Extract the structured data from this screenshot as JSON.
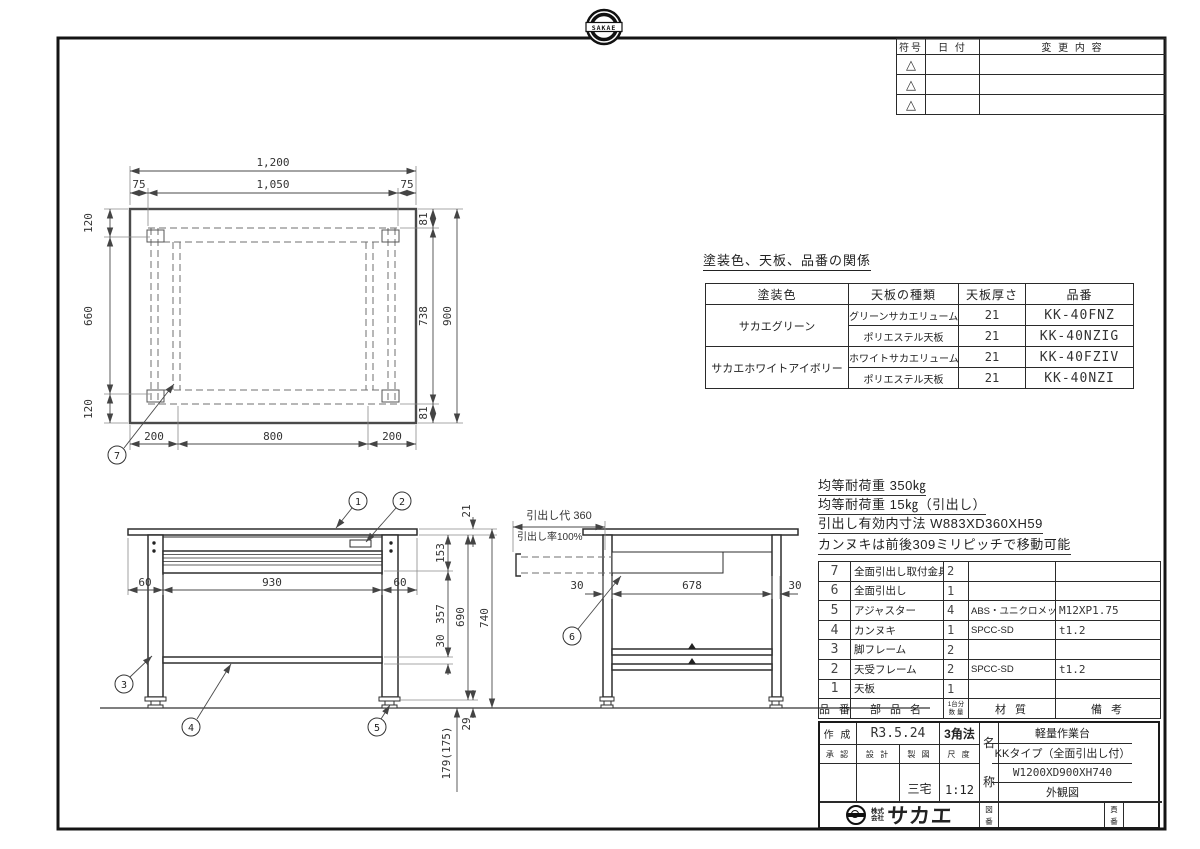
{
  "stamp": {
    "text": "SAKAE"
  },
  "rev": {
    "h_symbol": "符号",
    "h_date": "日 付",
    "h_change": "変 更 内 容",
    "triangle": "△"
  },
  "finish": {
    "title": "塗装色、天板、品番の関係",
    "h_color": "塗装色",
    "h_type": "天板の種類",
    "h_thick": "天板厚さ",
    "h_part": "品番",
    "color1": "サカエグリーン",
    "color2": "サカエホワイトアイボリー",
    "rows": [
      {
        "type": "グリーンサカエリューム天板",
        "thick": "21",
        "part": "KK-40FNZ"
      },
      {
        "type": "ポリエステル天板",
        "thick": "21",
        "part": "KK-40NZIG"
      },
      {
        "type": "ホワイトサカエリューム天板",
        "thick": "21",
        "part": "KK-40FZIV"
      },
      {
        "type": "ポリエステル天板",
        "thick": "21",
        "part": "KK-40NZI"
      }
    ]
  },
  "notes": {
    "line1": "均等耐荷重 350㎏",
    "line2": "均等耐荷重 15㎏（引出し）",
    "line3": "引出し有効内寸法 W883XD360XH59",
    "line4": "カンヌキは前後309ミリピッチで移動可能"
  },
  "parts": {
    "h_no": "品 番",
    "h_name": "部 品 名",
    "h_qty1": "1台分",
    "h_qty2": "数 量",
    "h_mat": "材 質",
    "h_rem": "備 考",
    "rows": [
      {
        "no": "7",
        "name": "全面引出し取付金具",
        "qty": "2",
        "mat": "",
        "rem": ""
      },
      {
        "no": "6",
        "name": "全面引出し",
        "qty": "1",
        "mat": "",
        "rem": ""
      },
      {
        "no": "5",
        "name": "アジャスター",
        "qty": "4",
        "mat": "ABS・ユニクロメッキ",
        "rem": "M12XP1.75"
      },
      {
        "no": "4",
        "name": "カンヌキ",
        "qty": "1",
        "mat": "SPCC-SD",
        "rem": "t1.2"
      },
      {
        "no": "3",
        "name": "脚フレーム",
        "qty": "2",
        "mat": "",
        "rem": ""
      },
      {
        "no": "2",
        "name": "天受フレーム",
        "qty": "2",
        "mat": "SPCC-SD",
        "rem": "t1.2"
      },
      {
        "no": "1",
        "name": "天板",
        "qty": "1",
        "mat": "",
        "rem": ""
      }
    ]
  },
  "tb": {
    "created_label": "作 成",
    "created_date": "R3.5.24",
    "projection": "3角法",
    "approve": "承 認",
    "design": "設 計",
    "draft": "製 図",
    "scale_label": "尺 度",
    "drafter": "三宅",
    "scale": "1:12",
    "nc1": "名",
    "nc2": "称",
    "name1": "軽量作業台",
    "name2": "KKタイプ（全面引出し付）",
    "name3": "W1200XD900XH740",
    "name4": "外観図",
    "co1": "株式",
    "co2": "会社",
    "co_name": "サカエ",
    "z1": "図",
    "z2": "番",
    "p1": "頁",
    "p2": "番"
  },
  "plan": {
    "d1200": "1,200",
    "d1050": "1,050",
    "d75l": "75",
    "d75r": "75",
    "d120t": "120",
    "d660": "660",
    "d120b": "120",
    "d81t": "81",
    "d738": "738",
    "d81b": "81",
    "d900": "900",
    "d200l": "200",
    "d800": "800",
    "d200r": "200",
    "balloon": "7"
  },
  "front": {
    "d21": "21",
    "d153": "153",
    "d60l": "60",
    "d930": "930",
    "d60r": "60",
    "d357": "357",
    "d30": "30",
    "d690": "690",
    "d740": "740",
    "d29": "29",
    "d179": "179(175)",
    "b1": "1",
    "b2": "2",
    "b3": "3",
    "b4": "4",
    "b5": "5"
  },
  "side": {
    "pull": "引出し代 360",
    "rate": "引出し率100%",
    "d30a": "30",
    "d678": "678",
    "d30b": "30",
    "balloon": "6"
  }
}
